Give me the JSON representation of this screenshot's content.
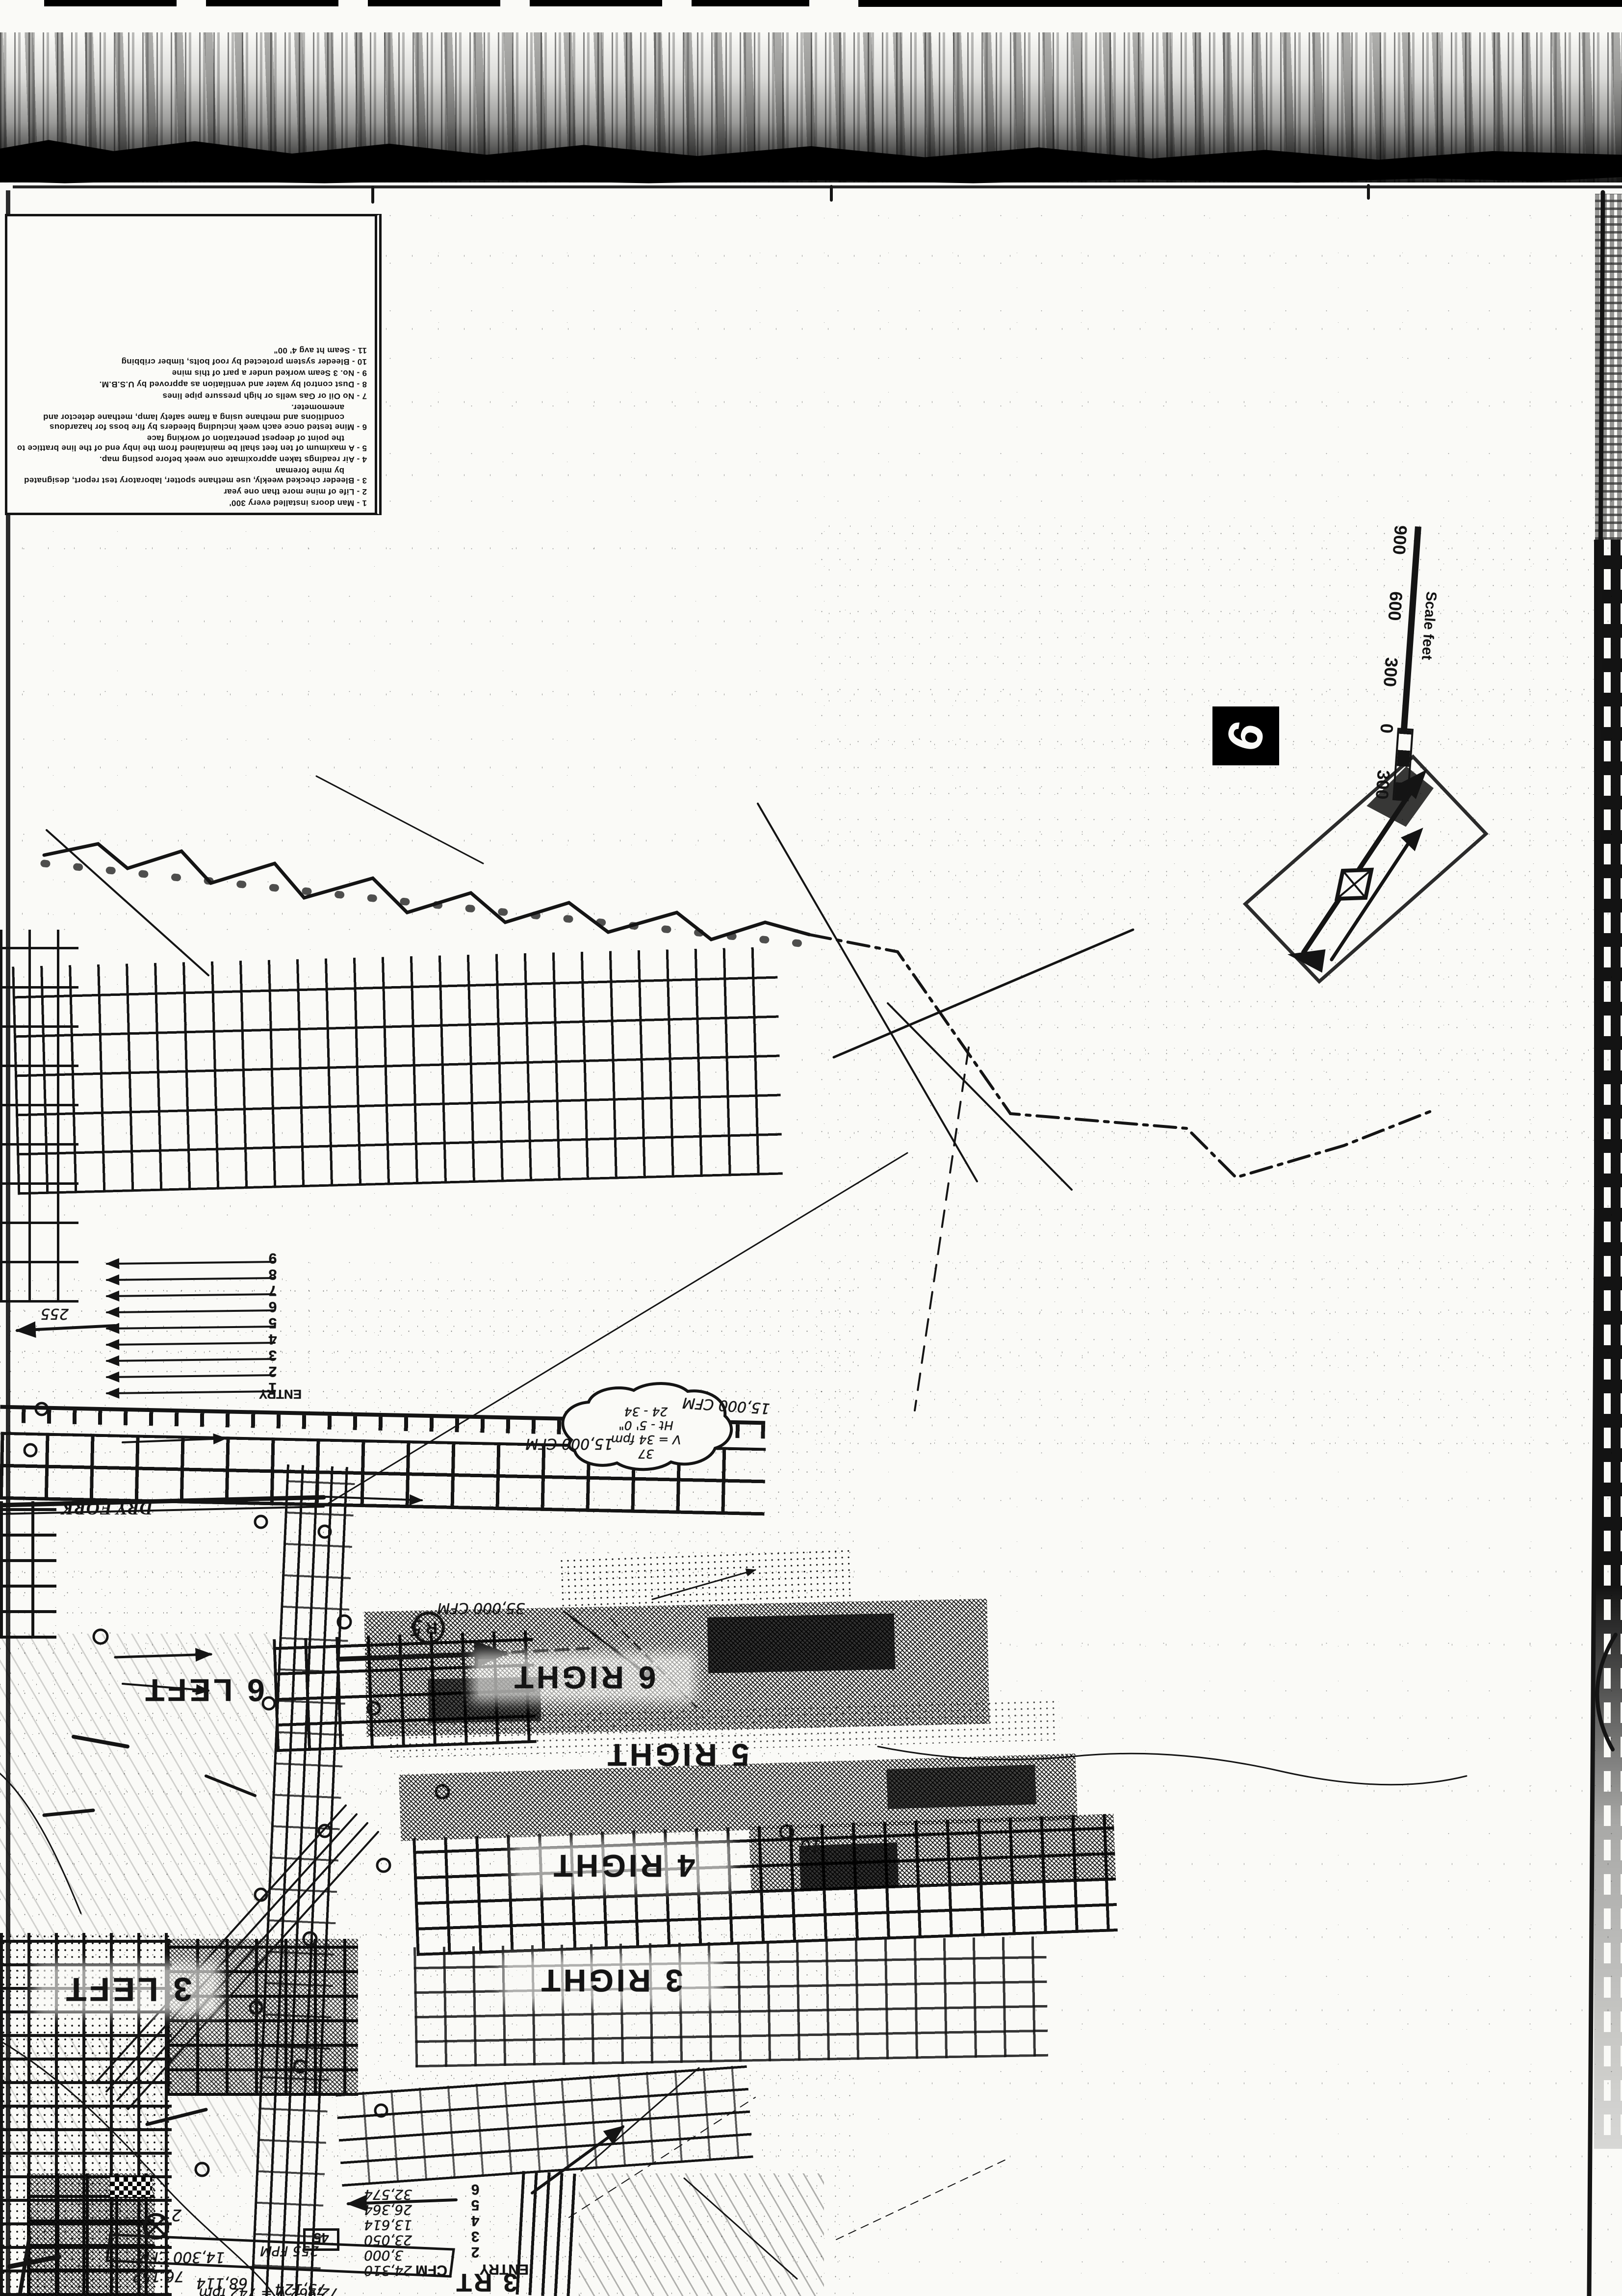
{
  "page": {
    "title": "Scanned mine ventilation map sheet",
    "ink": "#141414",
    "paper": "#fafaf7"
  },
  "legend": {
    "items": [
      "1 - Man doors installed every 300'",
      "2 - Life of mine more than one year",
      "3 - Bleeder checked weekly, use methane spotter, laboratory test report, designated by mine foreman",
      "4 - Air readings taken approximate one week before posting map.",
      "5 - A maximum of ten feet shall be maintained from the inby end of the line brattice to the point of deepest penetration of working face",
      "6 - Mine tested once each week including bleeders by fire boss for hazardous conditions and methane using a flame safety lamp, methane detector and anemometer.",
      "7 - No Oil or Gas wells or high pressure pipe lines",
      "8 - Dust control by water and ventilation as approved by U.S.B.M.",
      "9 - No. 3 Seam worked under a part of this mine",
      "10 - Bleeder system protected by roof bolts, timber cribbing",
      "11 - Seam ht avg 4' 00\""
    ]
  },
  "scale_bar": {
    "labels": [
      "300",
      "0",
      "300",
      "600",
      "900"
    ],
    "caption": "Scale feet"
  },
  "sheet_number": "6",
  "panel_labels": {
    "right6": "6 RIGHT",
    "right5": "5 RIGHT",
    "right4": "4 RIGHT",
    "right3": "3 RIGHT",
    "left6": "6 LEFT",
    "left3": "3 LEFT"
  },
  "stream_label": "DRY FORK",
  "entries": {
    "main_numbers": [
      "1",
      "2",
      "3",
      "4",
      "5",
      "6",
      "7",
      "8",
      "9"
    ],
    "main_label": "ENTRY",
    "main_reading": "255"
  },
  "rt3": {
    "label": "3 RT",
    "entry_label": "ENTRY",
    "cfm_label": "CFM",
    "entry_numbers": [
      "2",
      "3",
      "4",
      "5",
      "6"
    ],
    "cfm_values": [
      "24,310",
      "3,000",
      "23,050",
      "13,614",
      "26,364",
      "32,574"
    ]
  },
  "annotations": {
    "cfm_15a": "15,000 CFM",
    "cfm_15b": "15,000 CFM",
    "cfm_35": "35,000 CFM",
    "cfm_14300": "14,300 CFM",
    "v76152": "76,152",
    "v68114": "68,114",
    "v75124": "75,124",
    "v72962": "72,962  V = 742 fpm",
    "fpm_255": "255 FPM",
    "bubble": [
      "37",
      "V = 34 fpm",
      "Ht - 5' 0\"",
      "24 - 34"
    ],
    "regulator_letter": "R",
    "regulator_number": "5",
    "station_10": "10",
    "station_2": "2",
    "box_value": "45"
  }
}
